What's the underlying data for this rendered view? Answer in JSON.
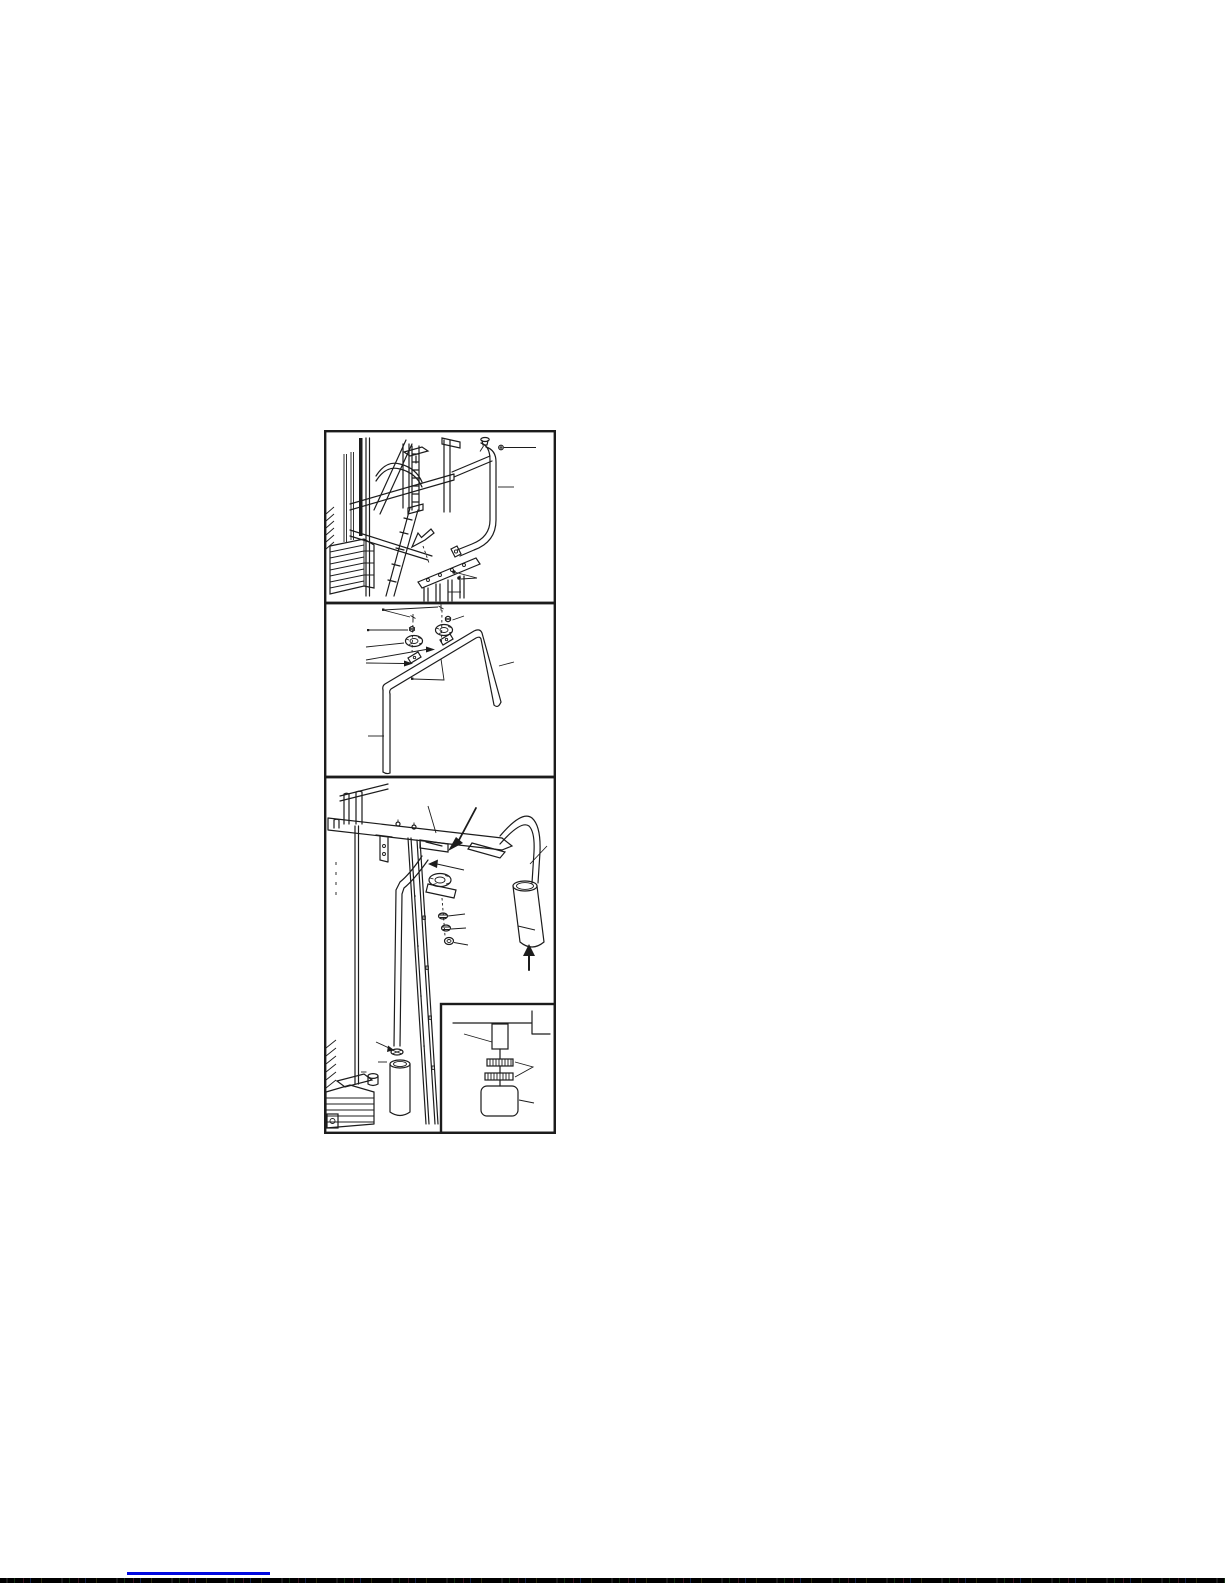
{
  "page": {
    "kind": "scanned-assembly-manual-page",
    "visible_text": "",
    "figure_count": 3
  },
  "colors": {
    "ink": "#1c1c1c",
    "paper": "#ffffff",
    "link": "#0008e0",
    "noise": "#050505"
  },
  "figures": [
    {
      "name": "frame-and-curved-bracket-assembly"
    },
    {
      "name": "u-bar-with-pulley-hardware-exploded"
    },
    {
      "name": "top-beam-roller-pad-and-weight-pin-inset"
    }
  ],
  "footer": {
    "link_underline": "hyperlink-underline-no-visible-text"
  }
}
